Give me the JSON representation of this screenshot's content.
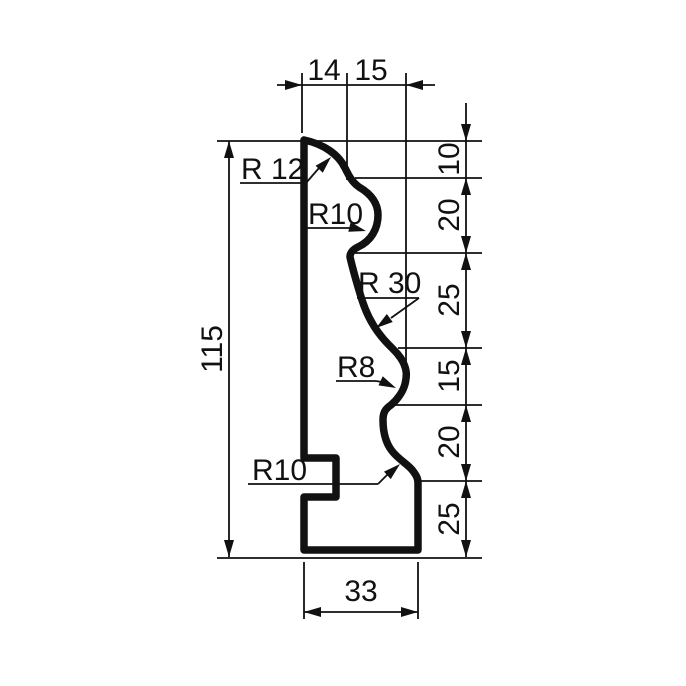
{
  "drawing": {
    "background": "#ffffff",
    "ink_color": "#111111",
    "dimensions": {
      "top_chain": [
        "14",
        "15"
      ],
      "right_chain": [
        "10",
        "20",
        "25",
        "15",
        "20",
        "25"
      ],
      "overall_height": "115",
      "bottom_width": "33"
    },
    "radius_callouts": [
      {
        "label": "R 12"
      },
      {
        "label": "R10"
      },
      {
        "label": "R 30"
      },
      {
        "label": "R8"
      },
      {
        "label": "R10"
      }
    ]
  }
}
